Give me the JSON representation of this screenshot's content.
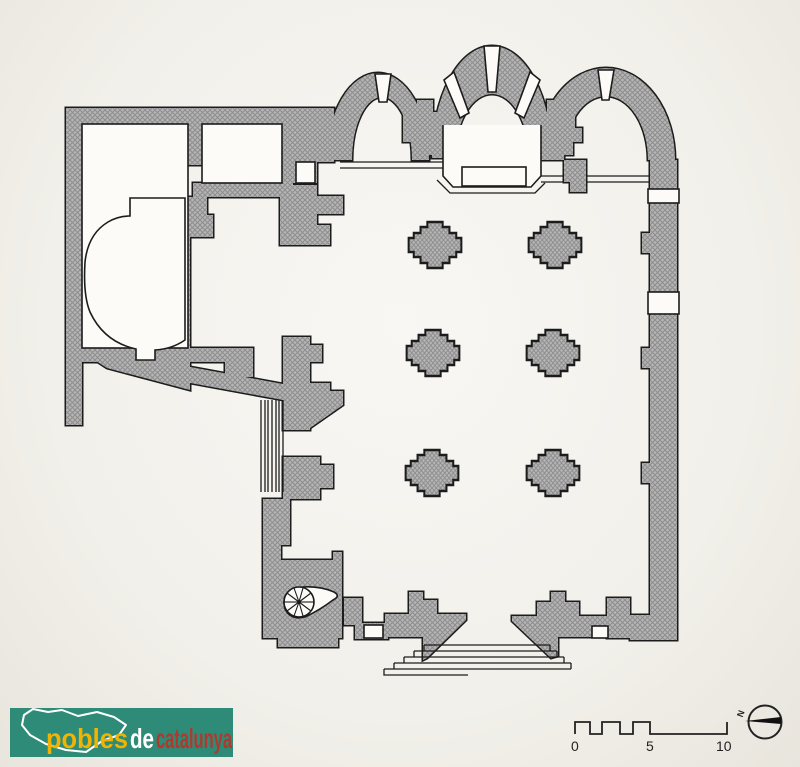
{
  "page": {
    "background": "#f2f0ec"
  },
  "plan": {
    "wall_fill": "#b6b6b6",
    "wall_hatch": "#8d8d8d",
    "outline": "#1c1c1c",
    "pillar_count": 6,
    "apse_count": 3
  },
  "scale_bar": {
    "labels": [
      "0",
      "5",
      "10"
    ]
  },
  "compass": {
    "label": "N"
  },
  "logo": {
    "background": "#2e8b77",
    "icon": "catalonia-map",
    "words": [
      {
        "text": "pobles",
        "color": "#f2b400"
      },
      {
        "text": "de",
        "color": "#ffffff"
      },
      {
        "text": "catalunya",
        "color": "#b0392e"
      }
    ]
  }
}
